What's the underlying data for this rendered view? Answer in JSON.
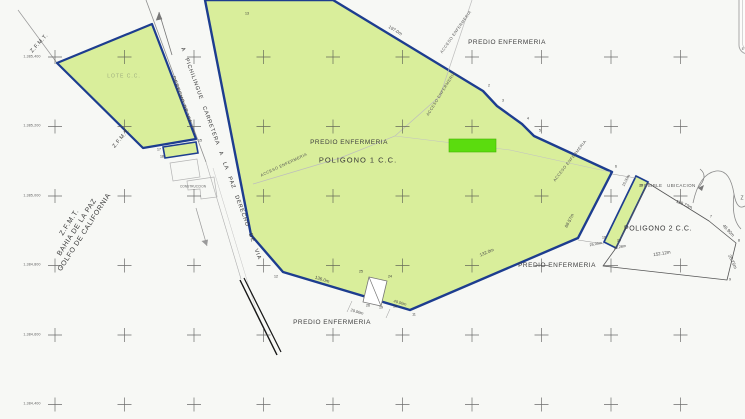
{
  "colors": {
    "paper": "#f7f8f5",
    "parcel_fill": "#d9ee9b",
    "boundary_blue": "#1d3d8f",
    "highlight_green": "#5bdc0e",
    "linework_gray": "#8a8a8a",
    "text_dark": "#3f3f3f"
  },
  "labels": {
    "zfmt_top": "Z.F.M.T.",
    "zfmt_mid": "Z.F.M.T.",
    "coast_line1": "Z.F.M.T.",
    "coast_line2": "BAHIA DE LA PAZ",
    "coast_line3": "GOLFO DE CALIFORNIA",
    "lote": "LOTE C.C.",
    "road": "A PICHILINGUE CARRETERA A LA PAZ DERECHO DE VIA",
    "derecho_left": "DERECHO DE VIA",
    "predio_top": "PREDIO ENFERMERIA",
    "predio_center": "PREDIO ENFERMERIA",
    "predio_right": "PREDIO ENFERMERIA",
    "predio_bottom": "PREDIO ENFERMERIA",
    "poligono1": "POLIGONO 1 C.C.",
    "poligono2": "POLIGONO 2 C.C.",
    "posible": "POSIBLE UBICACION",
    "acceso_a": "ACCESO ENFERMERIA",
    "acceso_b": "ACCESO ENFERMERIA",
    "acceso_c": "ACCESO ENFERMERIA",
    "acceso_d": "ACCESO ENFERMERIA",
    "construccion": "CONSTRUCCION",
    "coast_mark": "Z",
    "edge_letter": "E"
  },
  "dimensions": {
    "top_edge": "197.0m",
    "pol2_top": "118.73m",
    "pol2_right": "46.90m",
    "pol2_bottom": "152.12m",
    "pol2_side": "28.75m",
    "east_end": "68.57m",
    "bottom_right": "132.0m",
    "bottom_left": "136.0m",
    "bottom_a": "40.00m",
    "bottom_b": "20.00m",
    "gap_a": "25.00m",
    "gap_b": "15.28m",
    "gap_c": "15.00m"
  },
  "vertices": {
    "v13": "13",
    "s2": "2",
    "s3": "3",
    "s4": "4",
    "s5": "5",
    "s6": "6",
    "s21": "21",
    "b12": "12",
    "b11": "11",
    "b10": "10",
    "b26": "26",
    "b19": "19",
    "b25": "25",
    "b24": "24",
    "g16": "16",
    "g24": "24",
    "p7": "7",
    "p8": "8",
    "p9": "9",
    "k15": "15",
    "k17": "17",
    "k18": "18"
  },
  "grid_labels": [
    "1,385,400",
    "1,385,200",
    "1,385,000",
    "1,384,800",
    "1,384,600",
    "1,384,400"
  ]
}
